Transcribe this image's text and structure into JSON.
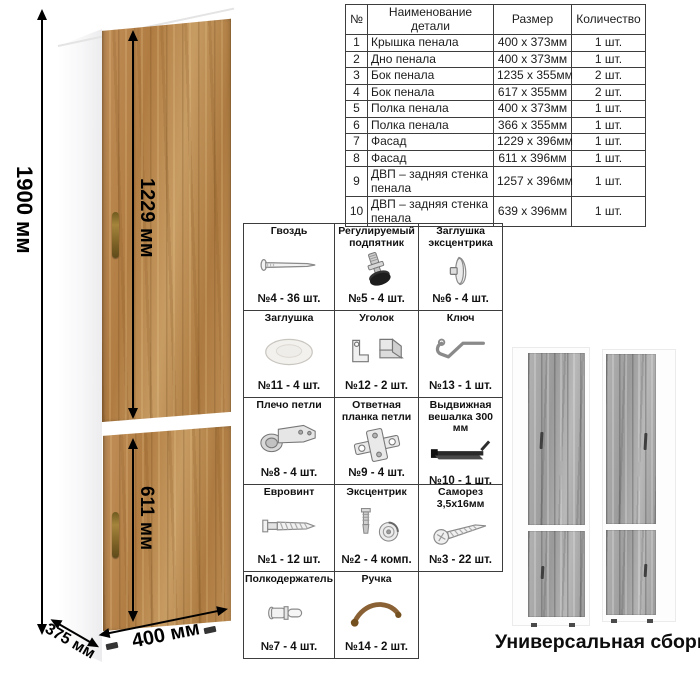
{
  "dimensions": {
    "height": "1900 мм",
    "upper_door": "1229 мм",
    "lower_door": "611 мм",
    "width": "400 мм",
    "depth": "375 мм"
  },
  "parts_table": {
    "headers": [
      "№",
      "Наименование детали",
      "Размер",
      "Количество"
    ],
    "rows": [
      [
        "1",
        "Крышка пенала",
        "400 х 373мм",
        "1 шт."
      ],
      [
        "2",
        "Дно пенала",
        "400 х 373мм",
        "1 шт."
      ],
      [
        "3",
        "Бок пенала",
        "1235 х 355мм",
        "2 шт."
      ],
      [
        "4",
        "Бок пенала",
        "617 х 355мм",
        "2 шт."
      ],
      [
        "5",
        "Полка пенала",
        "400 х 373мм",
        "1 шт."
      ],
      [
        "6",
        "Полка пенала",
        "366 х 355мм",
        "1 шт."
      ],
      [
        "7",
        "Фасад",
        "1229 х 396мм",
        "1 шт."
      ],
      [
        "8",
        "Фасад",
        "611 х 396мм",
        "1 шт."
      ],
      [
        "9",
        "ДВП – задняя стенка пенала",
        "1257 х 396мм",
        "1 шт."
      ],
      [
        "10",
        "ДВП – задняя стенка пенала",
        "639 х 396мм",
        "1 шт."
      ]
    ]
  },
  "hardware": {
    "cells": [
      {
        "title": "Гвоздь",
        "qty": "№4 - 36 шт.",
        "icon": "nail-icon"
      },
      {
        "title": "Регулируемый подпятник",
        "qty": "№5 - 4 шт.",
        "icon": "adjustable-foot-icon"
      },
      {
        "title": "Заглушка эксцентрика",
        "qty": "№6 - 4 шт.",
        "icon": "cam-cap-icon"
      },
      {
        "title": "Заглушка",
        "qty": "№11 - 4 шт.",
        "icon": "cap-icon"
      },
      {
        "title": "Уголок",
        "qty": "№12 - 2 шт.",
        "icon": "corner-bracket-icon"
      },
      {
        "title": "Ключ",
        "qty": "№13 - 1 шт.",
        "icon": "key-icon"
      },
      {
        "title": "Плечо петли",
        "qty": "№8 - 4 шт.",
        "icon": "hinge-arm-icon"
      },
      {
        "title": "Ответная планка петли",
        "qty": "№9 - 4 шт.",
        "icon": "hinge-plate-icon"
      },
      {
        "title": "Выдвижная вешалка 300 мм",
        "qty": "№10 - 1 шт.",
        "icon": "pullout-hanger-icon"
      },
      {
        "title": "Евровинт",
        "qty": "№1 - 12 шт.",
        "icon": "confirmat-screw-icon"
      },
      {
        "title": "Эксцентрик",
        "qty": "№2 - 4 комп.",
        "icon": "cam-lock-icon"
      },
      {
        "title": "Саморез 3,5х16мм",
        "qty": "№3 - 22 шт.",
        "icon": "self-tapping-screw-icon"
      },
      {
        "title": "Полкодержатель",
        "qty": "№7 - 4 шт.",
        "icon": "shelf-pin-icon"
      },
      {
        "title": "Ручка",
        "qty": "№14 - 2 шт.",
        "icon": "handle-icon"
      },
      {
        "title": "",
        "qty": "",
        "icon": ""
      }
    ]
  },
  "footer": {
    "caption": "Универсальная сборка."
  },
  "colors": {
    "wood_oak": "#b9854e",
    "wood_gray": "#a5a5a5",
    "handle_bronze": "#8a6134",
    "dimension_black": "#000000",
    "table_border": "#3d3d3d"
  }
}
